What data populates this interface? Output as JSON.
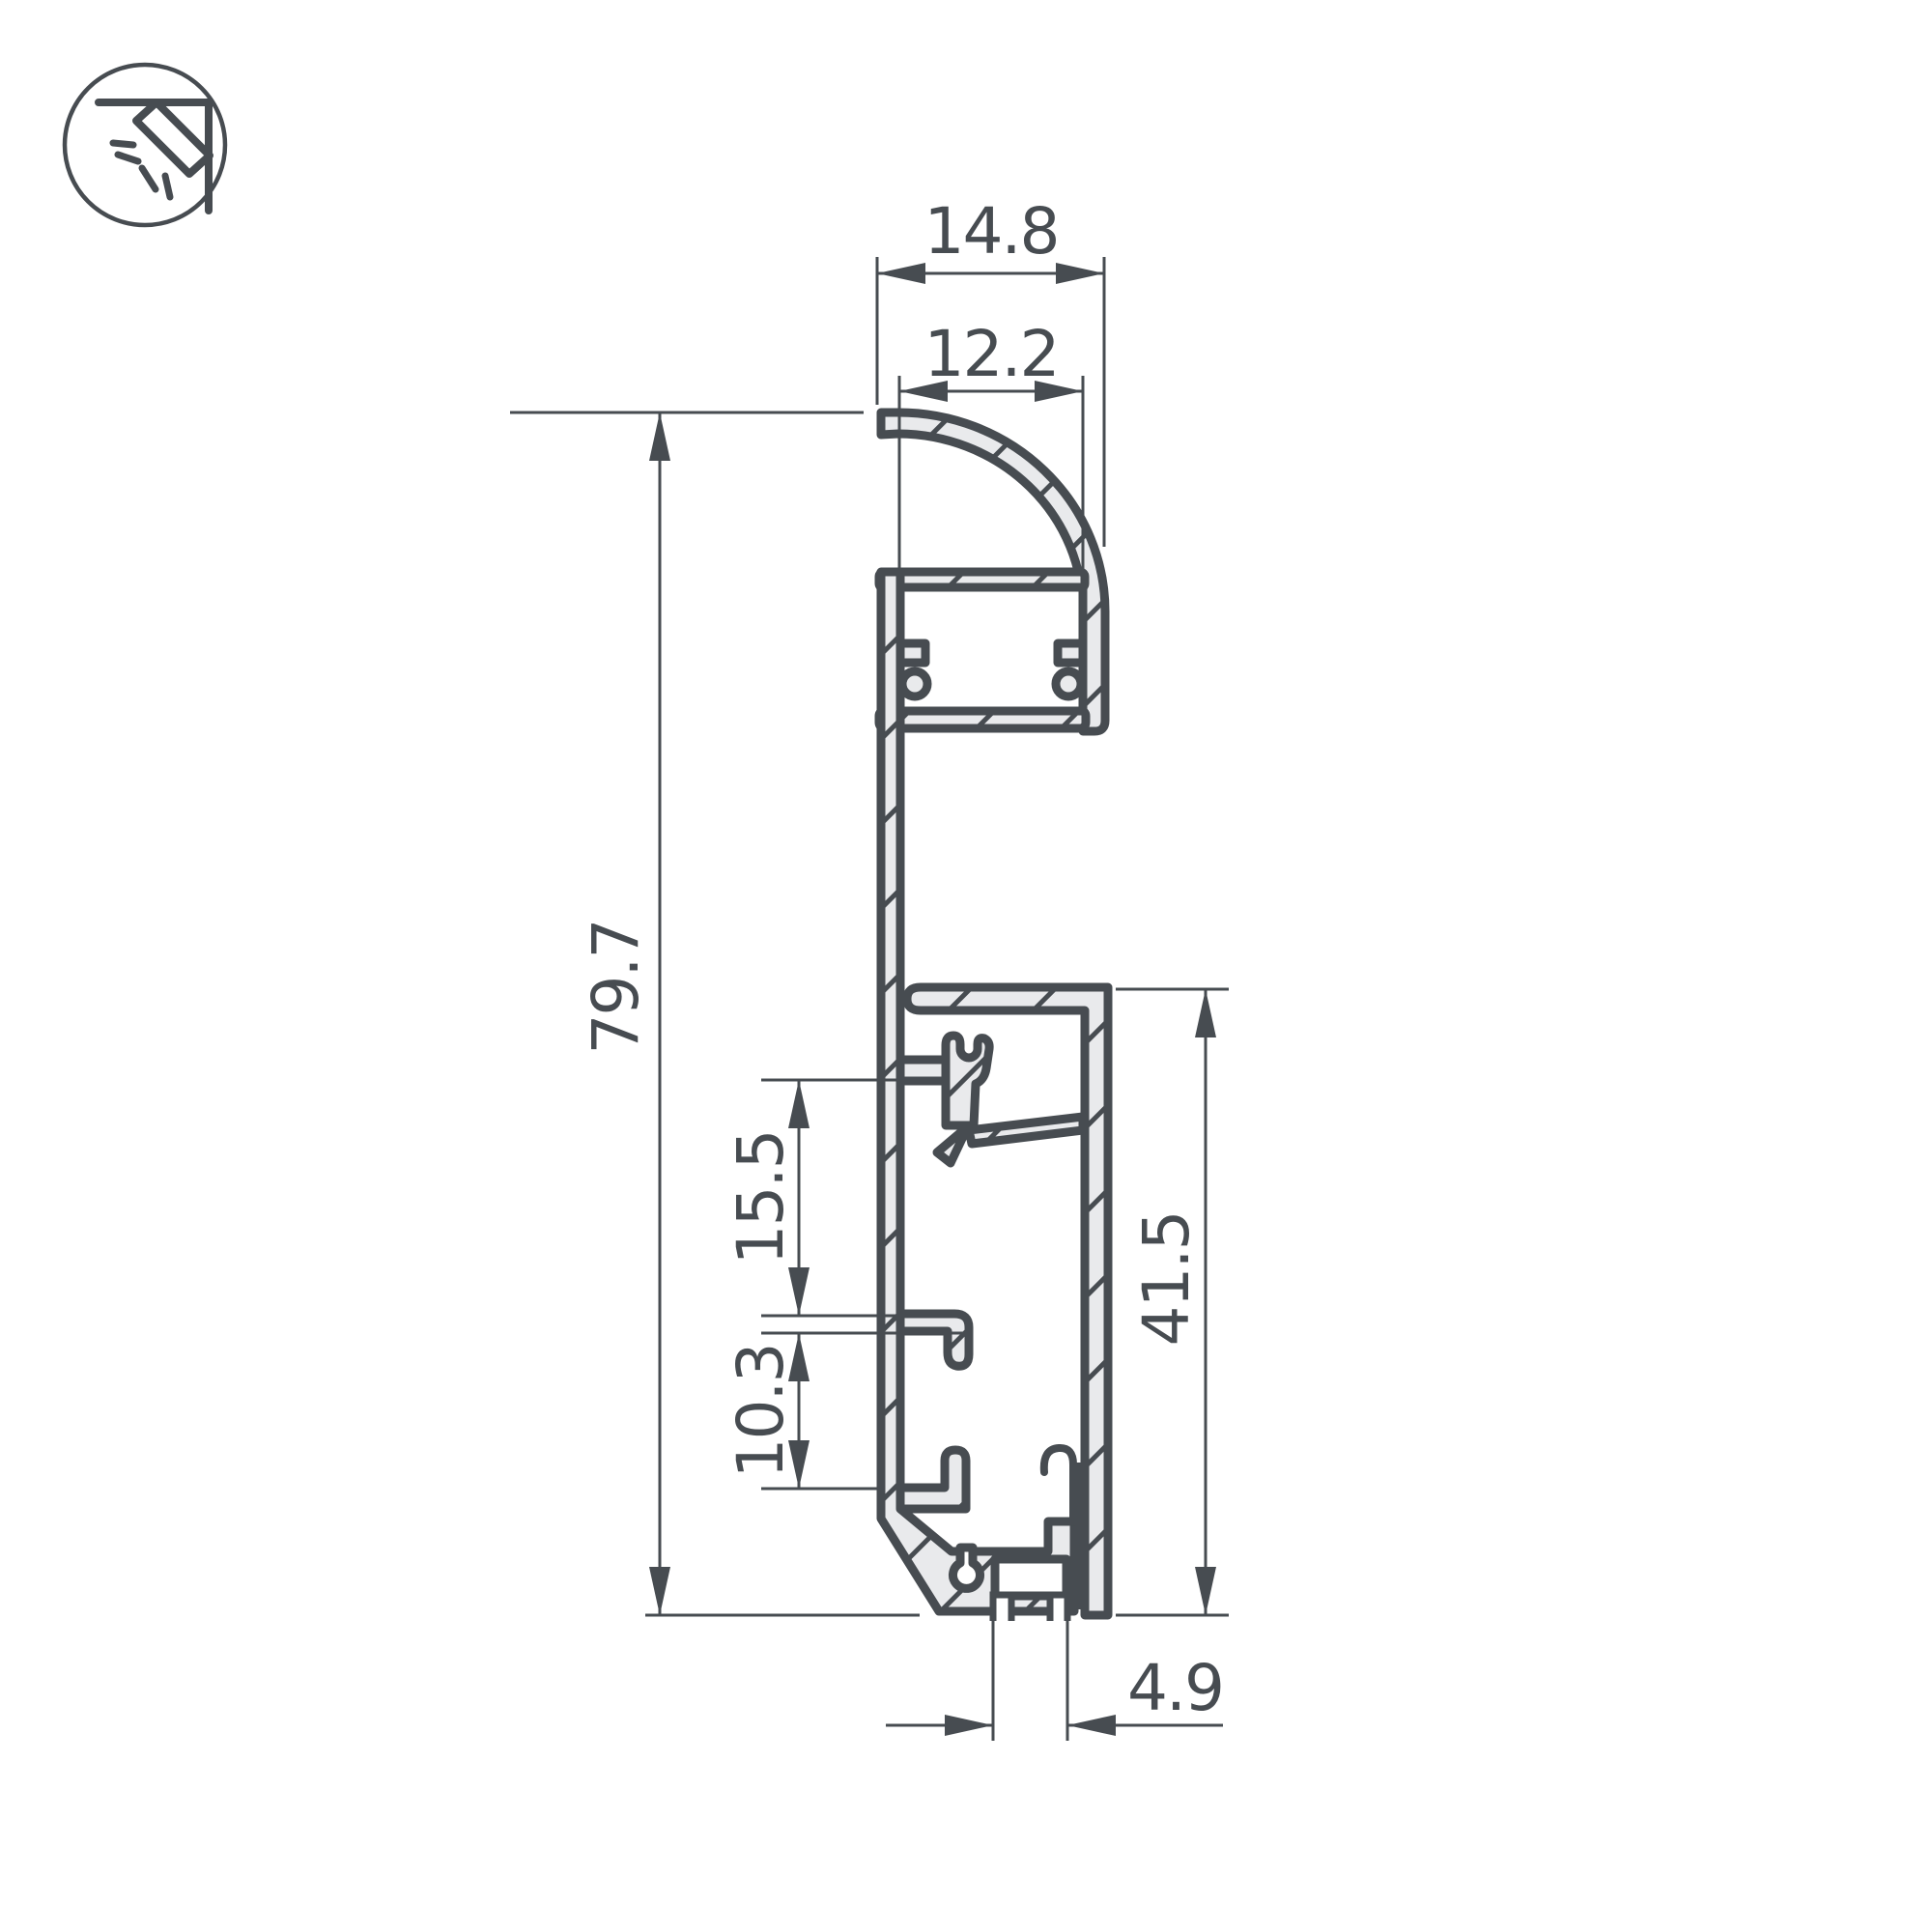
{
  "icon": {
    "name": "corner-light-icon"
  },
  "drawing": {
    "dimensions": {
      "top_width": "14.8",
      "top_inner_width": "12.2",
      "overall_height": "79.7",
      "clip_to_hook_spacing": "15.5",
      "hook_spacing": "10.3",
      "base_height": "41.5",
      "bottom_slot_width": "4.9"
    },
    "colors": {
      "line": "#474c51",
      "fill": "#e9eaec",
      "background": "#ffffff"
    }
  }
}
